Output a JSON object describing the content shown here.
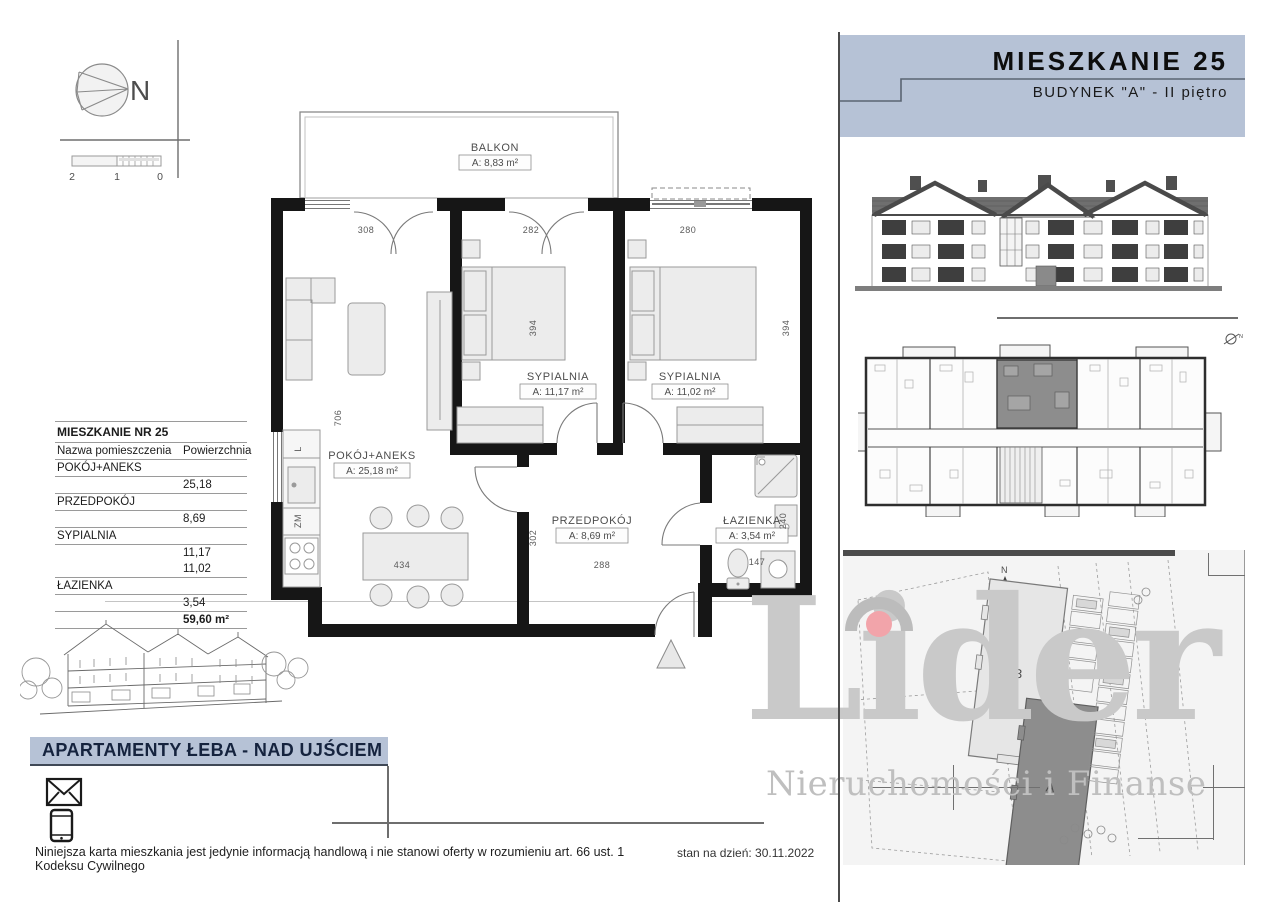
{
  "header": {
    "title": "MIESZKANIE 25",
    "subtitle": "BUDYNEK \"A\" - II piętro"
  },
  "compass": {
    "north_label": "N"
  },
  "scalebar": {
    "labels": [
      "2",
      "1",
      "0"
    ]
  },
  "floorplan": {
    "rooms": {
      "balkon": {
        "name": "BALKON",
        "area": "A: 8,83 m²"
      },
      "sypialnia1": {
        "name": "SYPIALNIA",
        "area": "A: 11,17 m²"
      },
      "sypialnia2": {
        "name": "SYPIALNIA",
        "area": "A: 11,02 m²"
      },
      "pokoj": {
        "name": "POKÓJ+ANEKS",
        "area": "A: 25,18 m²"
      },
      "przedpokoj": {
        "name": "PRZEDPOKÓJ",
        "area": "A: 8,69 m²"
      },
      "lazienka": {
        "name": "ŁAZIENKA",
        "area": "A: 3,54 m²"
      }
    },
    "dims": {
      "d308": "308",
      "d282": "282",
      "d280": "280",
      "d394a": "394",
      "d394b": "394",
      "d706": "706",
      "d302": "302",
      "d288": "288",
      "d434": "434",
      "d147": "147",
      "d240": "240"
    },
    "kitchen": {
      "fridge": "L",
      "dishwasher": "ZM"
    }
  },
  "table": {
    "title": "MIESZKANIE NR 25",
    "col_name": "Nazwa pomieszczenia",
    "col_area": "Powierzchnia",
    "r1_name": "POKÓJ+ANEKS",
    "r1_val": "25,18",
    "r2_name": "PRZEDPOKÓJ",
    "r2_val": "8,69",
    "r3_name": "SYPIALNIA",
    "r3_val1": "11,17",
    "r3_val2": "11,02",
    "r4_name": "ŁAZIENKA",
    "r4_val": "3,54",
    "total": "59,60 m²"
  },
  "project": {
    "title": "APARTAMENTY ŁEBA - NAD UJŚCIEM"
  },
  "footer": {
    "disclaimer": "Niniejsza karta mieszkania jest jedynie informacją handlową i nie stanowi oferty w rozumieniu art. 66 ust. 1 Kodeksu Cywilnego",
    "date": "stan na dzień: 30.11.2022"
  },
  "watermark": {
    "brand": "Lider",
    "tagline": "Nieruchomości i Finanse"
  },
  "siteplan": {
    "north_label": "N",
    "building_a": "A",
    "building_b": "B"
  },
  "colors": {
    "band": "#b6c2d6",
    "navy": "#15233e",
    "accent_pink": "#f2a4aa",
    "highlight_gray": "#8d8d8d"
  }
}
